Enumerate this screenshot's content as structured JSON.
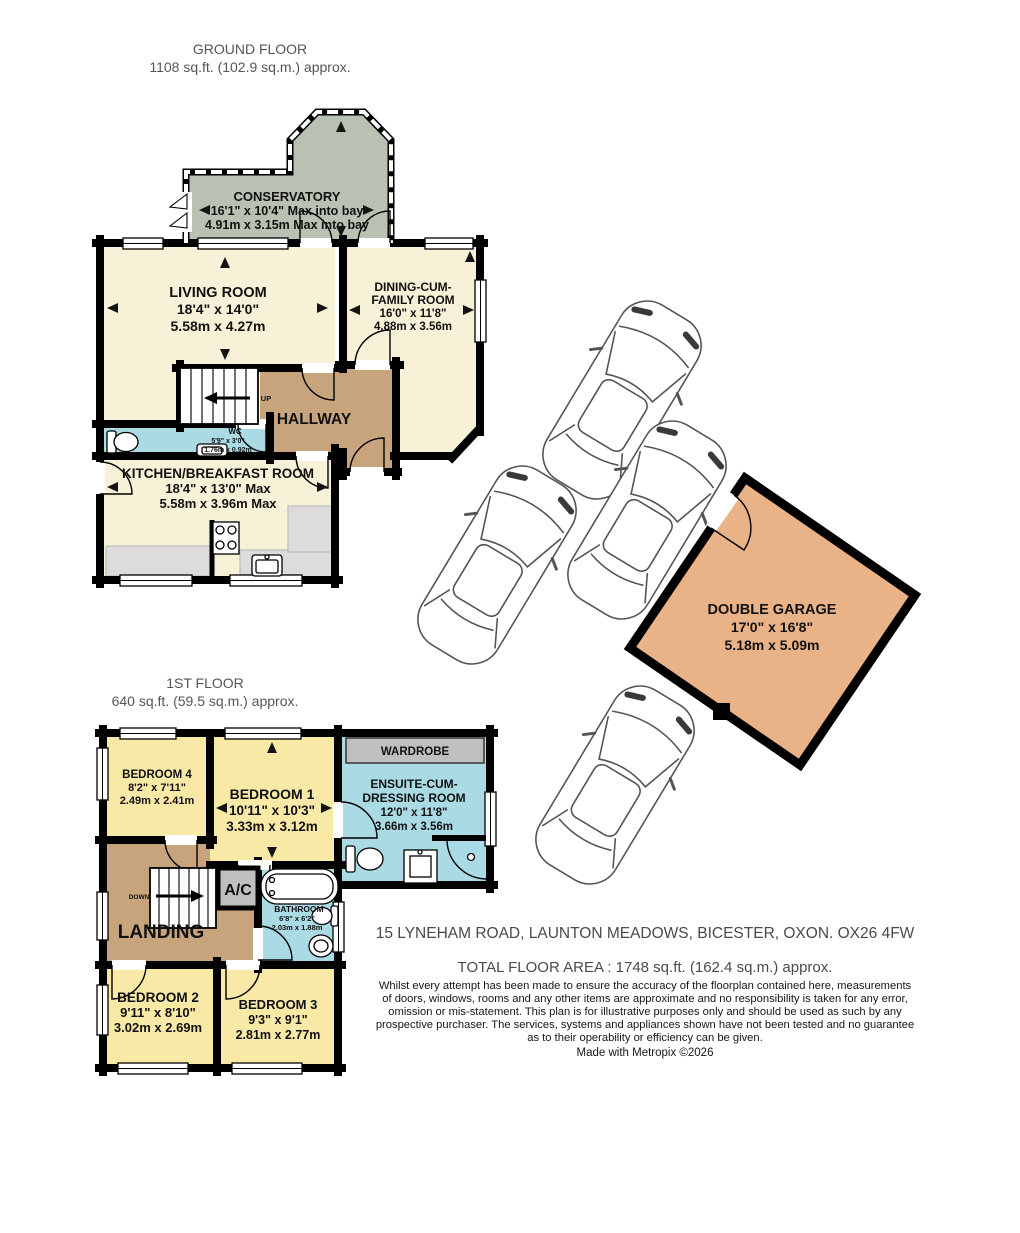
{
  "colors": {
    "cream": "#f7f1d7",
    "yellow": "#f9e9a7",
    "tan": "#c8a47c",
    "blue": "#aadae4",
    "green": "#b9c1b3",
    "orange": "#eab287",
    "counter": "#dcdcdc",
    "gray": "#bfbfbf",
    "wall": "#000000"
  },
  "ground_floor": {
    "title": "GROUND FLOOR",
    "area": "1108 sq.ft. (102.9 sq.m.) approx.",
    "conservatory": {
      "name": "CONSERVATORY",
      "imperial": "16'1\" x 10'4\" Max into bay",
      "metric": "4.91m x 3.15m Max into bay"
    },
    "living_room": {
      "name": "LIVING ROOM",
      "imperial": "18'4\" x 14'0\"",
      "metric": "5.58m x 4.27m"
    },
    "dining_room": {
      "name_line1": "DINING-CUM-",
      "name_line2": "FAMILY ROOM",
      "imperial": "16'0\" x 11'8\"",
      "metric": "4.88m x 3.56m"
    },
    "hallway": {
      "name": "HALLWAY"
    },
    "stairs": {
      "label": "UP"
    },
    "wc": {
      "name": "WC",
      "imperial": "5'9\" x 3'0\"",
      "metric": "1.76m x 0.92m"
    },
    "kitchen": {
      "name": "KITCHEN/BREAKFAST ROOM",
      "imperial": "18'4\" x 13'0\" Max",
      "metric": "5.58m x 3.96m Max"
    },
    "garage": {
      "name": "DOUBLE GARAGE",
      "imperial": "17'0\" x 16'8\"",
      "metric": "5.18m x 5.09m"
    }
  },
  "first_floor": {
    "title": "1ST FLOOR",
    "area": "640 sq.ft. (59.5 sq.m.) approx.",
    "bedroom1": {
      "name": "BEDROOM 1",
      "imperial": "10'11\" x 10'3\"",
      "metric": "3.33m x 3.12m"
    },
    "bedroom2": {
      "name": "BEDROOM 2",
      "imperial": "9'11\" x 8'10\"",
      "metric": "3.02m x 2.69m"
    },
    "bedroom3": {
      "name": "BEDROOM 3",
      "imperial": "9'3\" x 9'1\"",
      "metric": "2.81m x 2.77m"
    },
    "bedroom4": {
      "name": "BEDROOM 4",
      "imperial": "8'2\" x 7'11\"",
      "metric": "2.49m x 2.41m"
    },
    "wardrobe": {
      "name": "WARDROBE"
    },
    "ensuite": {
      "name_line1": "ENSUITE-CUM-",
      "name_line2": "DRESSING ROOM",
      "imperial": "12'0\" x 11'8\"",
      "metric": "3.66m x 3.56m"
    },
    "landing": {
      "name": "LANDING"
    },
    "stairs": {
      "label": "DOWN"
    },
    "ac": {
      "name": "A/C"
    },
    "bathroom": {
      "name": "BATHROOM",
      "imperial": "6'8\" x 6'2\"",
      "metric": "2.03m x 1.88m"
    }
  },
  "footer": {
    "address": "15 LYNEHAM ROAD, LAUNTON MEADOWS, BICESTER, OXON. OX26 4FW",
    "total_area": "TOTAL FLOOR AREA : 1748 sq.ft. (162.4 sq.m.) approx.",
    "disclaimer_line1": "Whilst every attempt has been made to ensure the accuracy of the floorplan contained here, measurements",
    "disclaimer_line2": "of doors, windows, rooms and any other items are approximate and no responsibility is taken for any error,",
    "disclaimer_line3": "omission or mis-statement. This plan is for illustrative purposes only and should be used as such by any",
    "disclaimer_line4": "prospective purchaser. The services, systems and appliances shown have not been tested and no guarantee",
    "disclaimer_line5": "as to their operability or efficiency can be given.",
    "credit": "Made with Metropix ©2026"
  }
}
